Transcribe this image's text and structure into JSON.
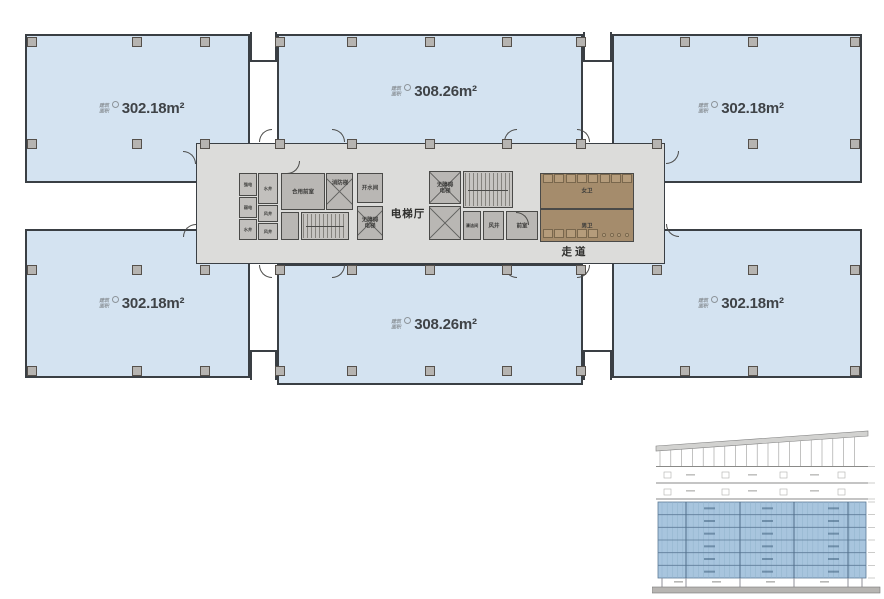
{
  "labels": {
    "area_prefix_line1": "建筑",
    "area_prefix_line2": "面积"
  },
  "rooms": [
    {
      "name": "top-left",
      "area": "302.18m²"
    },
    {
      "name": "top-middle",
      "area": "308.26m²"
    },
    {
      "name": "top-right",
      "area": "302.18m²"
    },
    {
      "name": "bottom-left",
      "area": "302.18m²"
    },
    {
      "name": "bottom-middle",
      "area": "308.26m²"
    },
    {
      "name": "bottom-right",
      "area": "302.18m²"
    }
  ],
  "core": {
    "elevator_hall": "电梯厅",
    "corridor": "走道",
    "shared_front_room": "合用前室",
    "fire_stair": "消防梯",
    "hot_water_room": "开水间",
    "accessible_elevator_left": "无障碍电梯",
    "accessible_elevator_right": "无障碍电梯",
    "air_shaft": "风井",
    "front_room": "前室",
    "cleaning_room": "清洁间",
    "womens_toilet": "女卫",
    "mens_toilet": "男卫",
    "shafts": [
      "强电",
      "弱电",
      "水井",
      "水井",
      "风井",
      "风井"
    ]
  },
  "colors": {
    "unit_fill": "#d4e3f1",
    "wall": "#3a3f44",
    "core_bg": "#dcdcda",
    "core_room_fill": "#b9b7b4",
    "toilet_fill": "#a58c6c",
    "column_fill": "#b6b4b1",
    "area_text": "#3f4347",
    "section_highlight": "#a8c5de"
  },
  "section_diagram": {
    "type": "building-section",
    "highlighted_floor_count": 6,
    "upper_floor_count": 2,
    "highlight_color": "#a8c5de"
  }
}
